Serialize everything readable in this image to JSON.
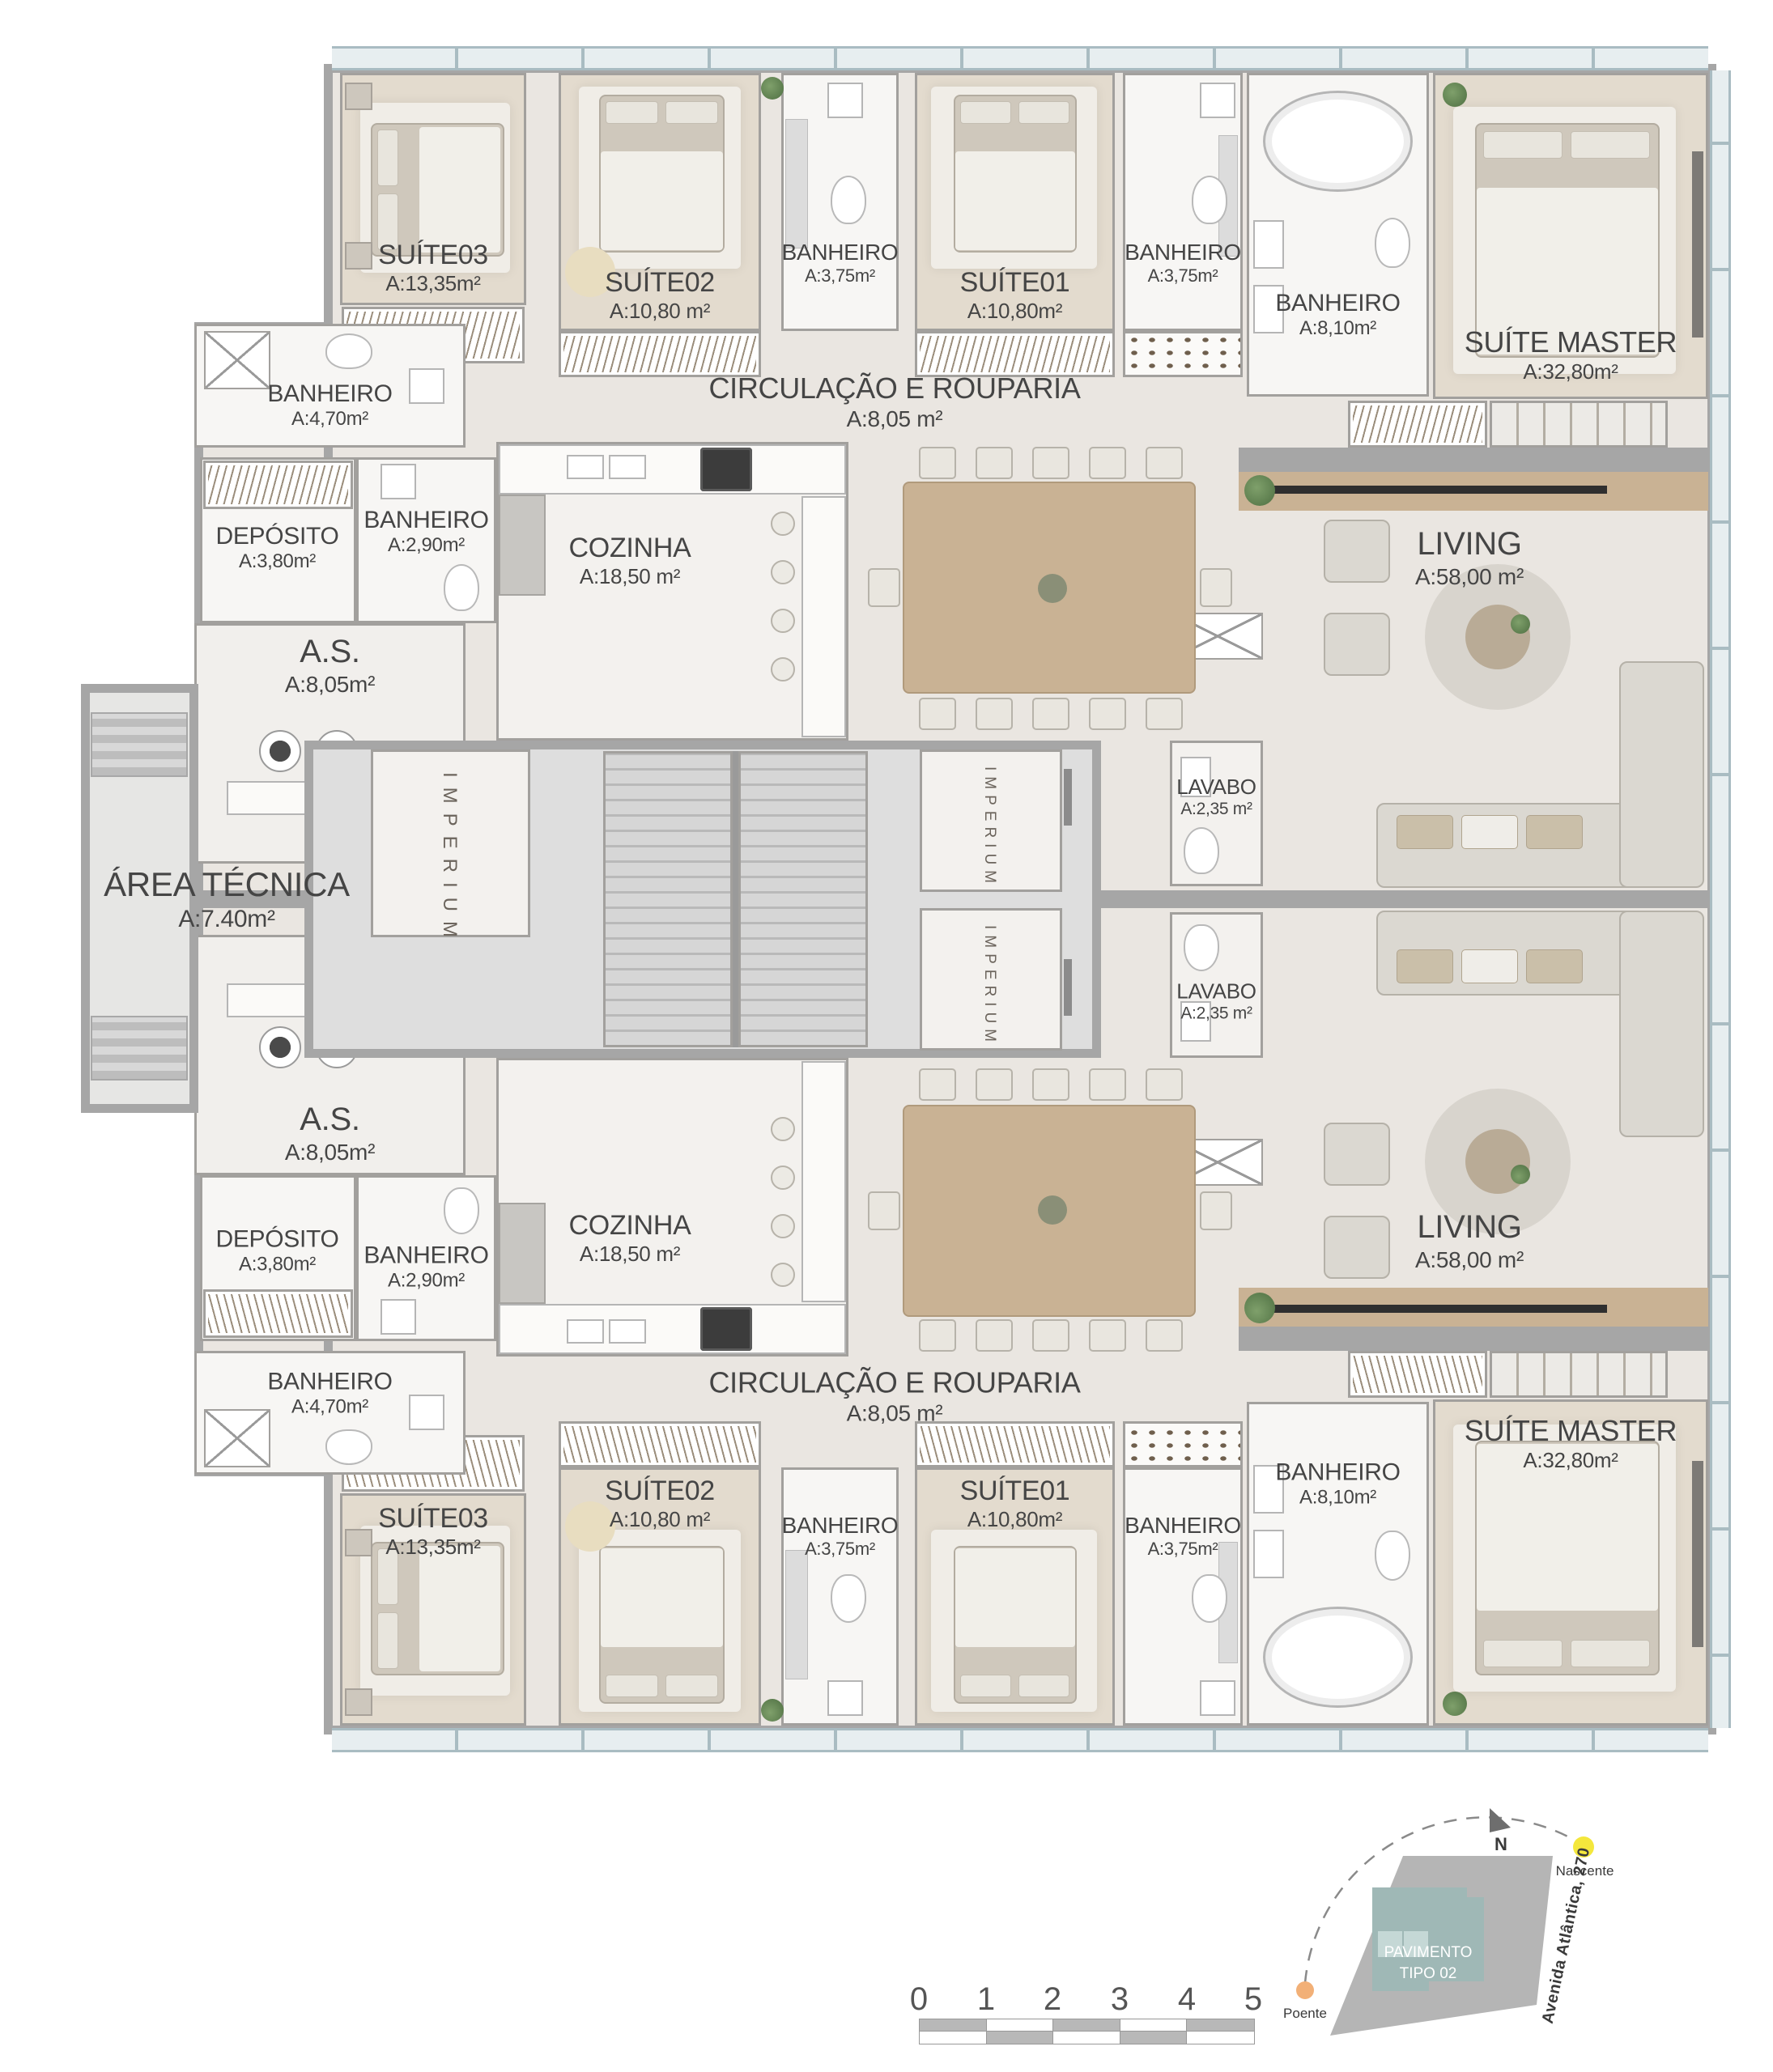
{
  "brand": "IMPERIUM",
  "rooms": {
    "suite03": {
      "name": "SUÍTE03",
      "area": "A:13,35m²"
    },
    "suite02": {
      "name": "SUÍTE02",
      "area": "A:10,80 m²"
    },
    "banheiro_suite02": {
      "name": "BANHEIRO",
      "area": "A:3,75m²"
    },
    "suite01": {
      "name": "SUÍTE01",
      "area": "A:10,80m²"
    },
    "banheiro_suite01": {
      "name": "BANHEIRO",
      "area": "A:3,75m²"
    },
    "banheiro_master": {
      "name": "BANHEIRO",
      "area": "A:8,10m²"
    },
    "suite_master": {
      "name": "SUÍTE MASTER",
      "area": "A:32,80m²"
    },
    "banheiro_social": {
      "name": "BANHEIRO",
      "area": "A:4,70m²"
    },
    "circulacao": {
      "name": "CIRCULAÇÃO E ROUPARIA",
      "area": "A:8,05 m²"
    },
    "deposito": {
      "name": "DEPÓSITO",
      "area": "A:3,80m²"
    },
    "banheiro_servico": {
      "name": "BANHEIRO",
      "area": "A:2,90m²"
    },
    "cozinha": {
      "name": "COZINHA",
      "area": "A:18,50 m²"
    },
    "area_servico": {
      "name": "A.S.",
      "area": "A:8,05m²"
    },
    "lavabo": {
      "name": "LAVABO",
      "area": "A:2,35 m²"
    },
    "living": {
      "name": "LIVING",
      "area": "A:58,00 m²"
    },
    "area_tecnica": {
      "name": "ÁREA TÉCNICA",
      "area": "A:7.40m²"
    }
  },
  "legend": {
    "north": "N",
    "nascente": "Nascente",
    "poente": "Poente",
    "building_line1": "PAVIMENTO",
    "building_line2": "TIPO 02",
    "street": "Avenida Atlântica, 270"
  },
  "scalebar": {
    "ticks": [
      "0",
      "1",
      "2",
      "3",
      "4",
      "5"
    ]
  },
  "colors": {
    "wall": "#a6a6a6",
    "slab": "#ccd6da",
    "floor": "#eae6e1",
    "wood-deck": "#c9b294",
    "site": "#b5b5b5",
    "building-fill": "#9fb8b6",
    "building-light": "#c5d8d6",
    "nascente-dot": "#f4e73c",
    "poente-dot": "#f2b077",
    "label": "#454545"
  }
}
